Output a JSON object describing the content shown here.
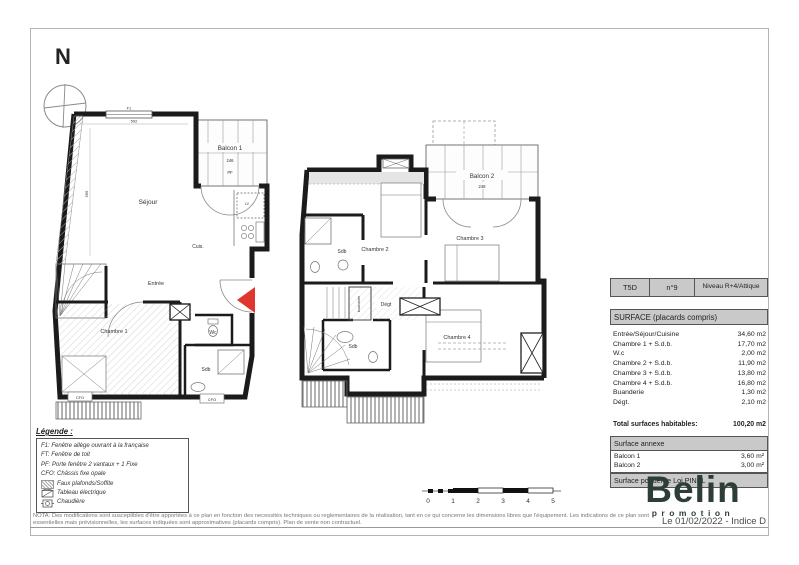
{
  "page": {
    "north_label": "N",
    "date_line": "Le 01/02/2022 - Indice D",
    "nota_line1": "NOTA: Des modifications sont susceptibles d'être apportées à ce plan en fonction des necessités techniques ou reglementaires de la réalisation, tant en ce qui concerne les dimensions libres que l'équipement. Les indications de ce plan sont",
    "nota_line2": "essentielles mais prévisionnelles, les surfaces indiquées sont approximatives (placards compris). Plan de vente non contractuel."
  },
  "colors": {
    "entrance_arrow_red": "#df372d",
    "logo_green": "#2d3e37",
    "table_header_gray": "#c9c9c9",
    "wall_black": "#1b1b1b"
  },
  "plan1": {
    "rooms": {
      "sejour": "Séjour",
      "cuisine": "Cuis.",
      "entree": "Entrée",
      "chambre1": "Chambre 1",
      "wc": "Wc",
      "sdb": "Sdb",
      "balcon": "Balcon 1"
    },
    "annotations": {
      "f1": "F1",
      "pf": "PF",
      "lv": "LV",
      "cfo": "CFO",
      "dim_balcon": "246",
      "dim_width": "592",
      "dim_height": "595"
    }
  },
  "plan2": {
    "rooms": {
      "chambre2": "Chambre 2",
      "chambre3": "Chambre 3",
      "chambre4": "Chambre 4",
      "sdb_haut": "Sdb",
      "sdb_bas": "Sdb",
      "degt": "Dégt",
      "buanderie": "buanderie",
      "balcon": "Balcon 2"
    },
    "annotations": {
      "dim_balcon": "248"
    }
  },
  "legend": {
    "title": "Légende :",
    "items": [
      "F1: Fenêtre allège ouvrant à la française",
      "FT: Fenêtre de toit",
      "PF: Porte fenêtre 2 vantaux + 1 Fixe",
      "CFO: Châssis fixe opale",
      "Faux plafonds/Soffite",
      "Tableau électrique",
      "Chaudière"
    ]
  },
  "table": {
    "type_label": "T5D",
    "num_label": "n°9",
    "niveau_label": "Niveau R+4/Attique",
    "surface_title": "SURFACE (placards compris)",
    "rows": [
      {
        "label": "Entrée/Séjour/Cuisine",
        "value": "34,60 m2"
      },
      {
        "label": "Chambre 1 + S.d.b.",
        "value": "17,70 m2"
      },
      {
        "label": "W.c",
        "value": "2,00 m2"
      },
      {
        "label": "Chambre 2 + S.d.b.",
        "value": "11,90 m2"
      },
      {
        "label": "Chambre 3 + S.d.b.",
        "value": "13,80 m2"
      },
      {
        "label": "Chambre 4 + S.d.b.",
        "value": "16,80 m2"
      },
      {
        "label": "Buanderie",
        "value": "1,30 m2"
      },
      {
        "label": "Dégt.",
        "value": "2,10 m2"
      }
    ],
    "total_label": "Total surfaces habitables:",
    "total_value": "100,20 m2",
    "annexe_title": "Surface annexe",
    "annexe_rows": [
      {
        "label": "Balcon 1",
        "value": "3,60 m²"
      },
      {
        "label": "Balcon 2",
        "value": "3,00 m²"
      }
    ],
    "pinel_title": "Surface pondérée Loi PINEL"
  },
  "logo": {
    "name": "Belin",
    "sub": "promotion"
  },
  "scalebar": {
    "ticks": [
      "0",
      "1",
      "2",
      "3",
      "4",
      "5"
    ]
  }
}
